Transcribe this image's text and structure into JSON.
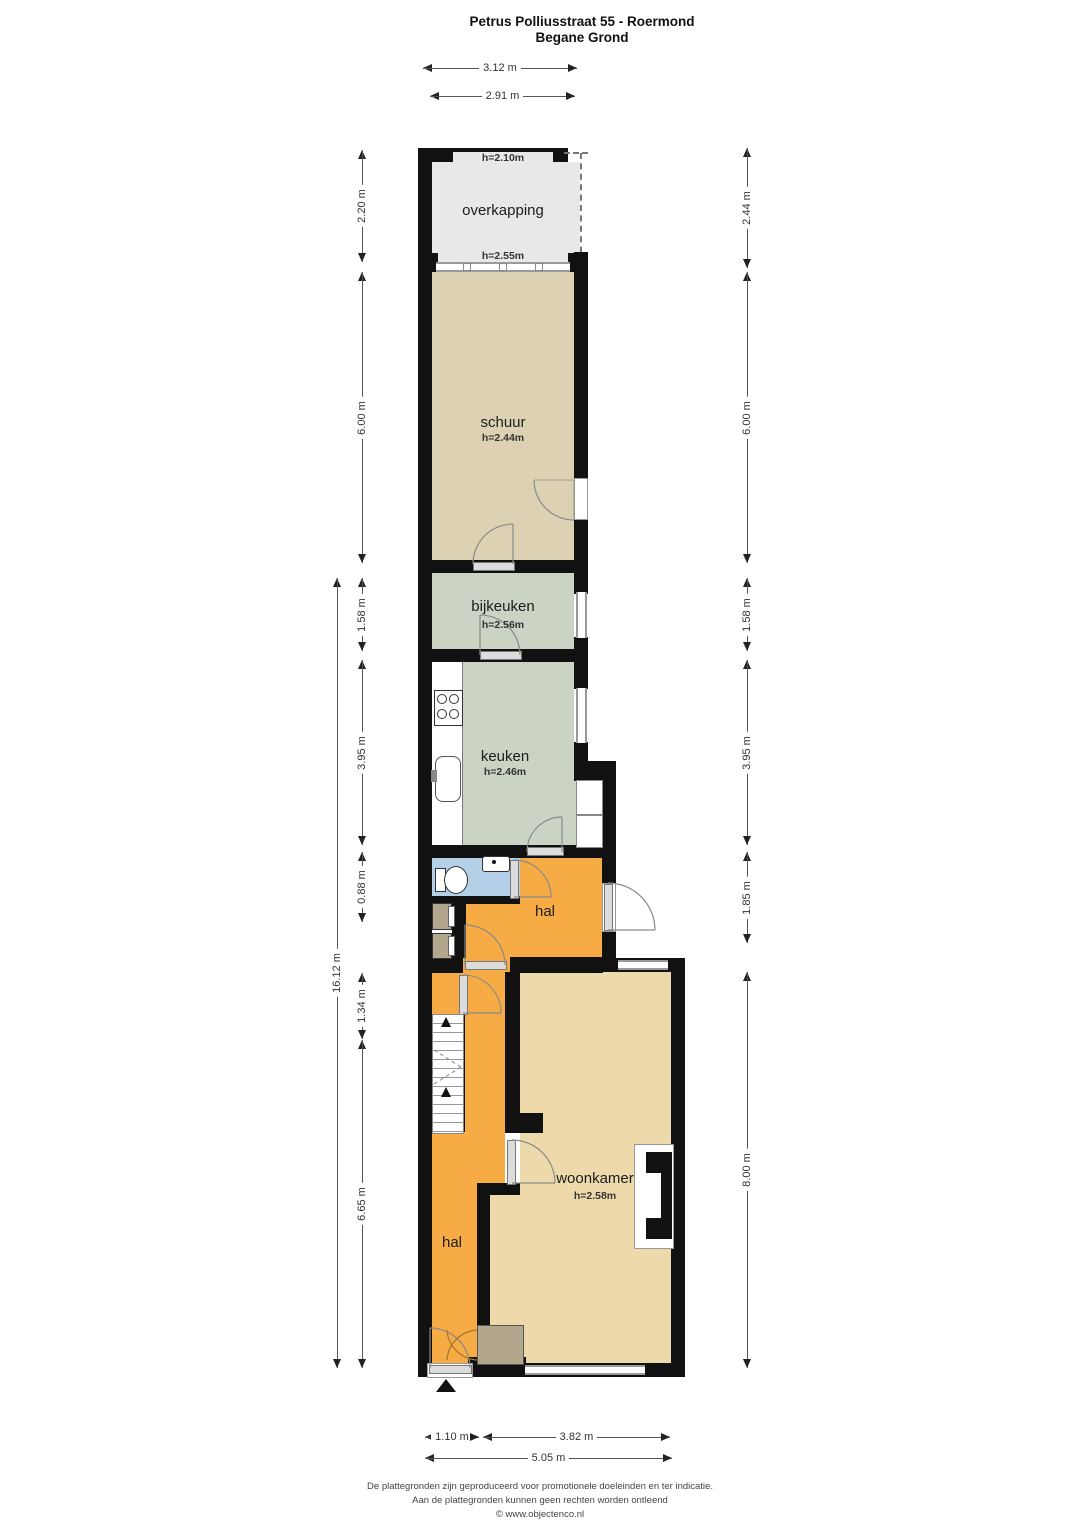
{
  "title": {
    "line1": "Petrus Polliusstraat 55 - Roermond",
    "line2": "Begane Grond"
  },
  "rooms": {
    "overkapping": {
      "label": "overkapping"
    },
    "schuur": {
      "label": "schuur",
      "height": "h=2.44m"
    },
    "bijkeuken": {
      "label": "bijkeuken",
      "height": "h=2.56m"
    },
    "keuken": {
      "label": "keuken",
      "height": "h=2.46m"
    },
    "hal_boven": {
      "label": "hal"
    },
    "woonkamer": {
      "label": "woonkamer",
      "height": "h=2.58m"
    },
    "hal_beneden": {
      "label": "hal"
    }
  },
  "annotations": {
    "overkapping_top": "h=2.10m",
    "overkapping_bottom": "h=2.55m"
  },
  "dimensions": {
    "top": [
      "3.12 m",
      "2.91 m"
    ],
    "left_outer": "16.12 m",
    "left": [
      "2.20 m",
      "6.00 m",
      "1.58 m",
      "3.95 m",
      "0.88 m",
      "1.34 m",
      "6.65 m"
    ],
    "right": [
      "2.44 m",
      "6.00 m",
      "1.58 m",
      "3.95 m",
      "1.85 m",
      "8.00 m"
    ],
    "bottom": [
      "1.10 m",
      "3.82 m",
      "5.05 m"
    ]
  },
  "footer": {
    "line1": "De plattegronden zijn geproduceerd voor promotionele doeleinden en ter indicatie.",
    "line2": "Aan de plattegronden kunnen geen rechten worden ontleend",
    "line3": "© www.objectenco.nl"
  },
  "colors": {
    "wall": "#111111",
    "overkapping": "#e8e8e8",
    "schuur": "#dcd2b3",
    "keuken": "#cbd3c4",
    "hal": "#f6ab44",
    "woonkamer": "#edd9aa",
    "toilet": "#b4cfe8",
    "kast": "#b2a68c"
  }
}
